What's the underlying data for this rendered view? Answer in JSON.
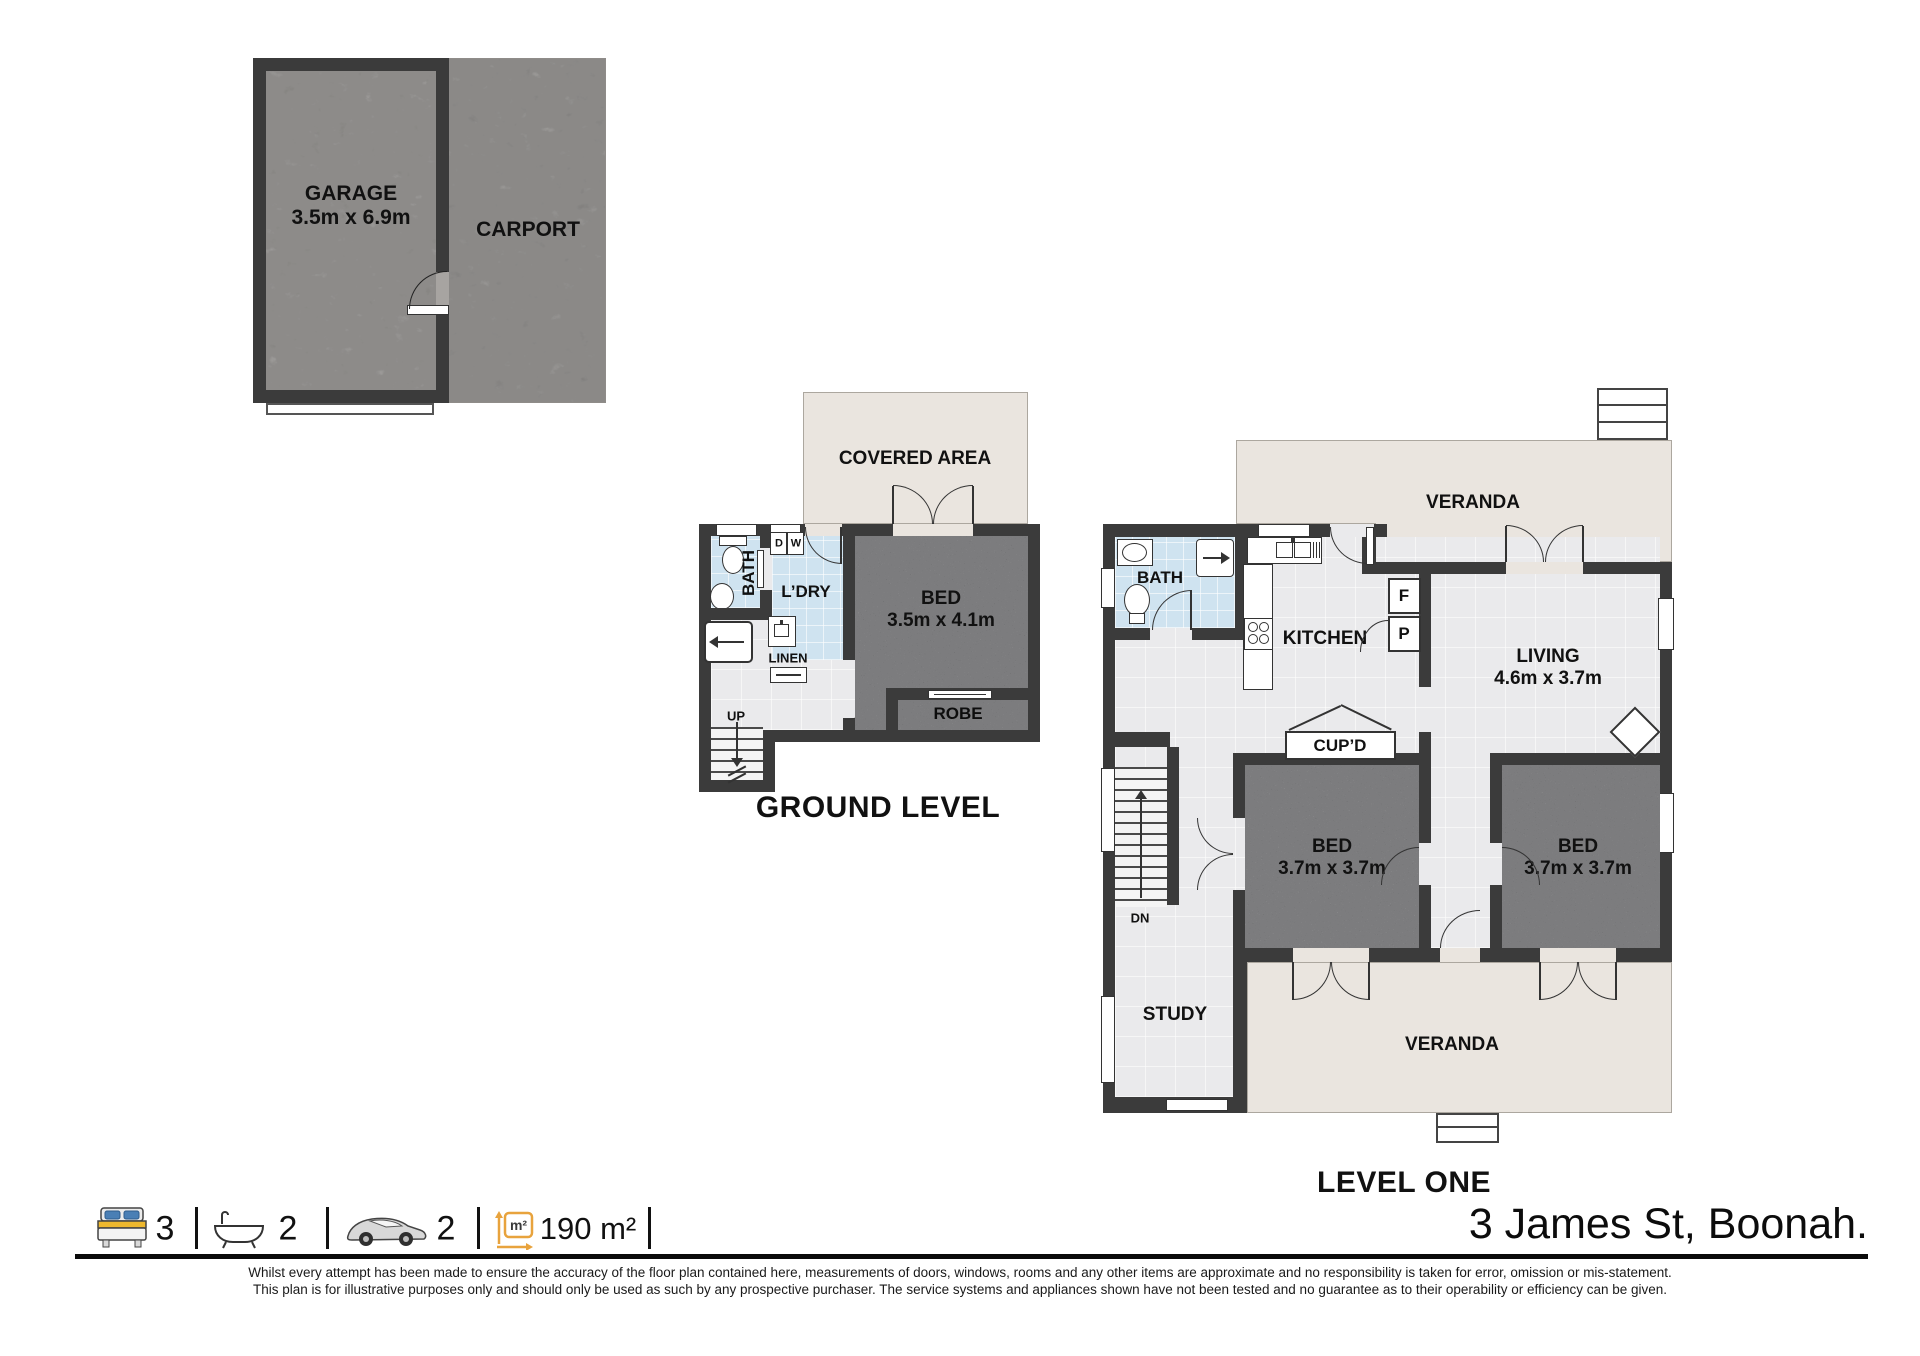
{
  "plans": {
    "garage": {
      "garage_label": "GARAGE",
      "garage_dims": "3.5m x 6.9m",
      "carport_label": "CARPORT"
    },
    "ground": {
      "title": "GROUND LEVEL",
      "covered_area": "COVERED AREA",
      "bath": "BATH",
      "laundry": "L’DRY",
      "dryer": "D",
      "washer": "W",
      "linen": "LINEN",
      "up": "UP",
      "bed": "BED",
      "bed_dims": "3.5m x 4.1m",
      "robe": "ROBE"
    },
    "level_one": {
      "title": "LEVEL ONE",
      "veranda_top": "VERANDA",
      "veranda_bottom": "VERANDA",
      "bath": "BATH",
      "kitchen": "KITCHEN",
      "fridge": "F",
      "pantry": "P",
      "cupboard": "CUP’D",
      "living": "LIVING",
      "living_dims": "4.6m x 3.7m",
      "bed_left": "BED",
      "bed_left_dims": "3.7m x 3.7m",
      "bed_right": "BED",
      "bed_right_dims": "3.7m x 3.7m",
      "down": "DN",
      "study": "STUDY"
    }
  },
  "footer": {
    "beds": "3",
    "baths": "2",
    "cars": "2",
    "area": "190 m²",
    "address": "3 James St, Boonah.",
    "disclaimer_line1": "Whilst every attempt has been made to ensure the accuracy of the floor plan contained here, measurements of doors, windows, rooms and any other items are approximate and no responsibility is taken for error, omission  or mis-statement.",
    "disclaimer_line2": "This plan is for illustrative purposes only and should only be used as such by any prospective purchaser. The service systems and appliances shown have not been tested and no guarantee as to their operability or efficiency can be given."
  },
  "colors": {
    "wall": "#3b3b3b",
    "floor": "#eaeaec",
    "tile": "#cfe3f0",
    "veranda": "#eae5df",
    "concrete": "#a7a4a1",
    "carpet": "#97989c",
    "accent": "#e8a33d"
  }
}
